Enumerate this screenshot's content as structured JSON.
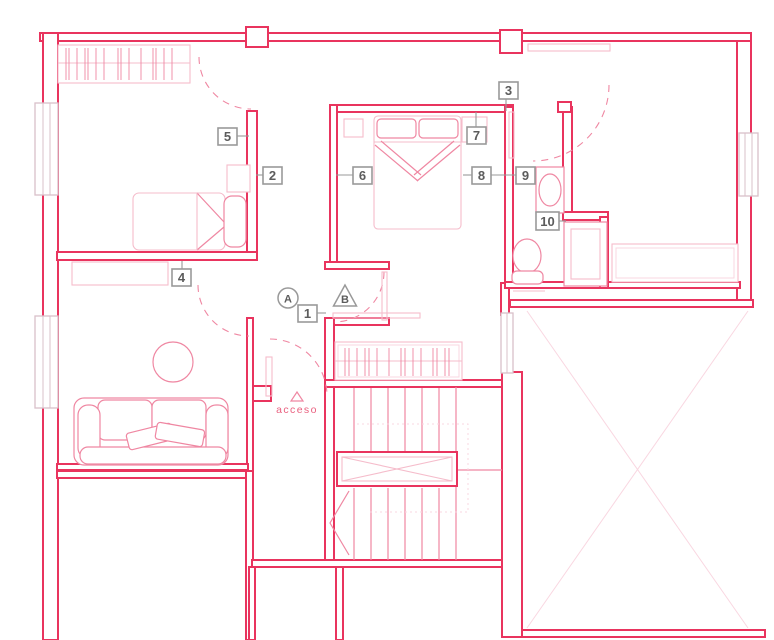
{
  "colors": {
    "wall": "#e9345e",
    "mid": "#ef87a2",
    "light": "#f5bccb",
    "faint": "#f9d7e1",
    "window": "#d9c0c9",
    "label-border": "#999999",
    "label-text": "#5c5c5c",
    "accent-text": "#e9607f",
    "background": "#ffffff"
  },
  "room_labels": {
    "n1": "1",
    "n2": "2",
    "n3": "3",
    "n4": "4",
    "n5": "5",
    "n6": "6",
    "n7": "7",
    "n8": "8",
    "n9": "9",
    "n10": "10"
  },
  "section_markers": {
    "a": "A",
    "b": "B"
  },
  "annotations": {
    "access": "acceso"
  }
}
